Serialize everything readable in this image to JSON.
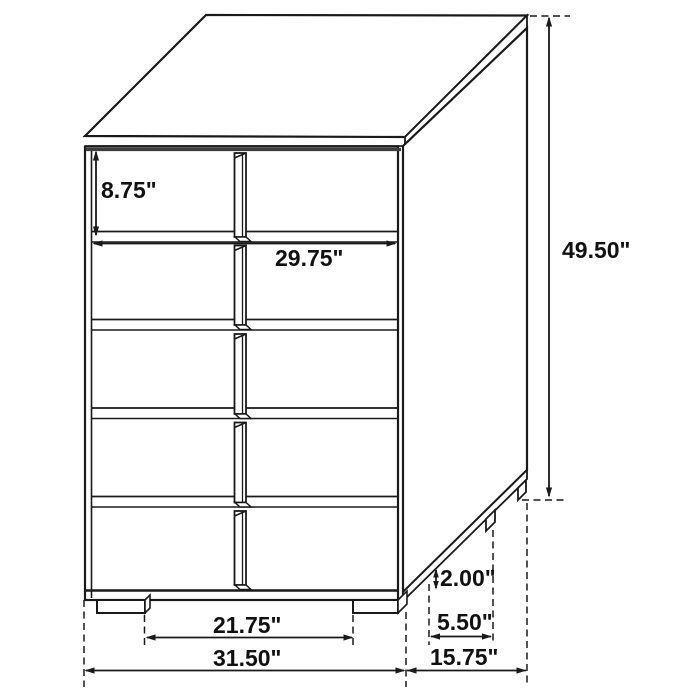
{
  "page": {
    "background": "#ffffff",
    "description": "Technical line drawing of a five-drawer chest with dimension callouts in inches"
  },
  "diagram": {
    "subject": "5-drawer chest",
    "drawer_count": 5,
    "line_color": "#1a1a1a",
    "shadow_color": "#3e3e3e"
  },
  "labels": {
    "drawer_height": "8.75\"",
    "drawer_width": "29.75\"",
    "overall_height": "49.50\"",
    "foot_height": "2.00\"",
    "side_foot_spacing": "5.50\"",
    "overall_depth": "15.75\"",
    "front_foot_spacing": "21.75\"",
    "overall_width": "31.50\""
  },
  "values_inches": {
    "drawer_height": 8.75,
    "drawer_width": 29.75,
    "overall_height": 49.5,
    "foot_height": 2.0,
    "side_foot_spacing": 5.5,
    "overall_depth": 15.75,
    "front_foot_spacing": 21.75,
    "overall_width": 31.5
  }
}
